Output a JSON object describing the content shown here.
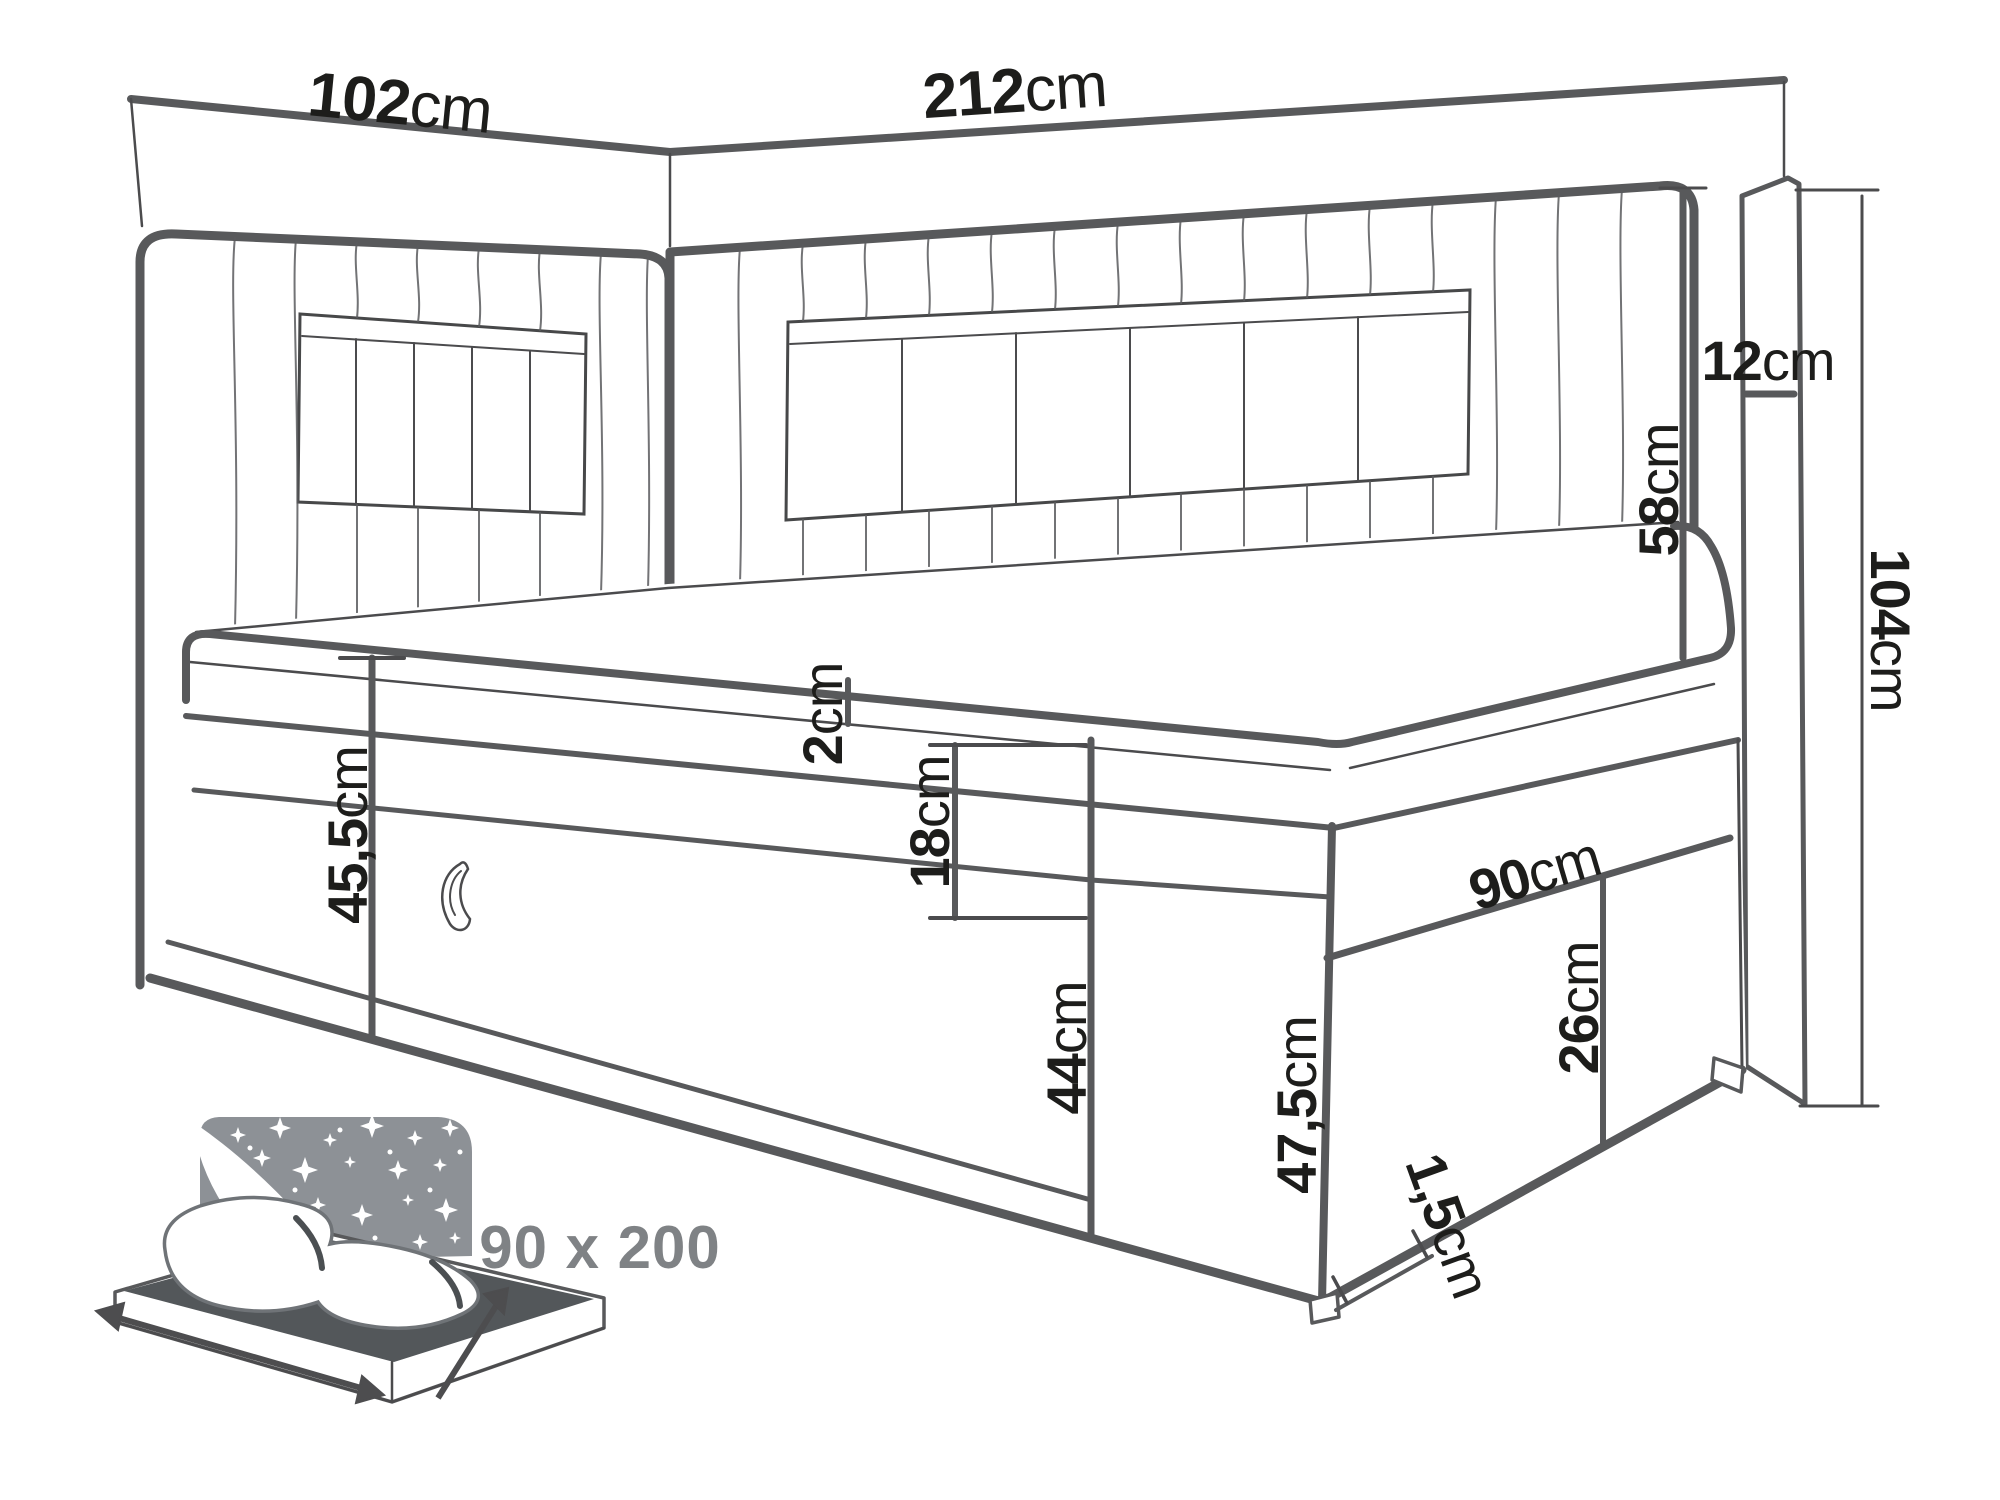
{
  "figure": {
    "type": "furniture-dimension-diagram",
    "subject": "corner daybed with headboard shelves and storage drawers"
  },
  "dimensions": {
    "left_width": {
      "value": "102",
      "unit": "cm"
    },
    "back_length": {
      "value": "212",
      "unit": "cm"
    },
    "top_rail": {
      "value": "12",
      "unit": "cm"
    },
    "headboard_above_mattress": {
      "value": "58",
      "unit": "cm"
    },
    "total_height": {
      "value": "104",
      "unit": "cm"
    },
    "seat_height": {
      "value": "45,5",
      "unit": "cm"
    },
    "topper_thickness": {
      "value": "2",
      "unit": "cm"
    },
    "drawer_front": {
      "value": "18",
      "unit": "cm"
    },
    "base_height": {
      "value": "44",
      "unit": "cm"
    },
    "corner_height": {
      "value": "47,5",
      "unit": "cm"
    },
    "foot_width": {
      "value": "90",
      "unit": "cm"
    },
    "foot_drawer": {
      "value": "26",
      "unit": "cm"
    },
    "floor_glide": {
      "value": "1,5",
      "unit": "cm"
    }
  },
  "icon_badge": {
    "icon": "bed-with-starry-headboard-icon",
    "label": "90 x 200"
  },
  "colors": {
    "background": "#ffffff",
    "line": "#58595b",
    "thin_line": "#4b4b4d",
    "label_text": "#1d1d1b",
    "icon_gray": "#8d9196",
    "icon_dark": "#53575a",
    "icon_text": "#7f8285"
  }
}
